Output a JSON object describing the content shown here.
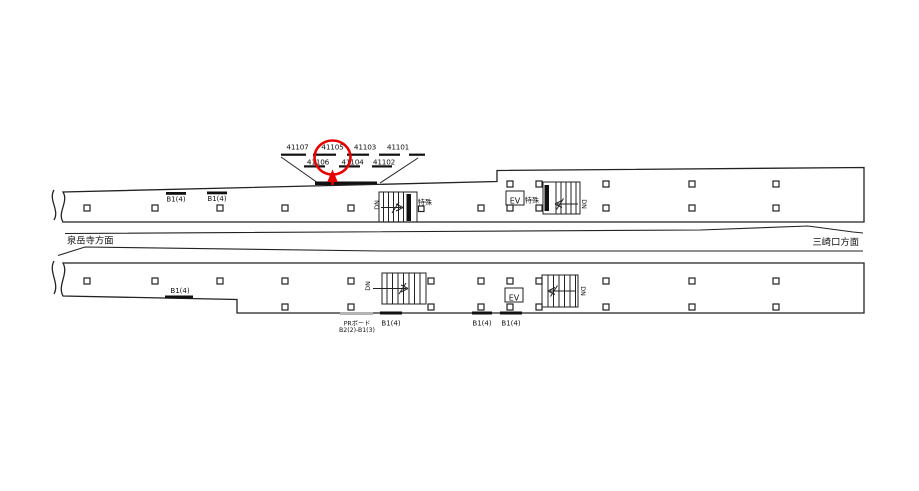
{
  "fan": {
    "top_numbers": [
      "41107",
      "41105",
      "41103",
      "41101"
    ],
    "bottom_numbers": [
      "41106",
      "41104",
      "41102"
    ],
    "highlighted_number": "41105"
  },
  "directions": {
    "left": "泉岳寺方面",
    "right": "三崎口方面"
  },
  "top_platform": {
    "signs": [
      "B1(4)",
      "B1(4)"
    ],
    "stair_left_dn": "DN",
    "stair_left_special": "特殊",
    "elevator": "EV",
    "stair_right_special": "特殊",
    "stair_right_dn": "DN"
  },
  "bottom_platform": {
    "left_sign": "B1(4)",
    "stair_left_dn": "DN",
    "elevator": "EV",
    "stair_right_dn": "DN",
    "pr_board_line1": "PRボード",
    "pr_board_line2": "B2(2)-B1(3)",
    "signs": [
      "B1(4)",
      "B1(4)",
      "B1(4)"
    ]
  },
  "colors": {
    "ink": "#222222",
    "highlight": "#e60000",
    "gray_bar": "#b3b3b3"
  }
}
